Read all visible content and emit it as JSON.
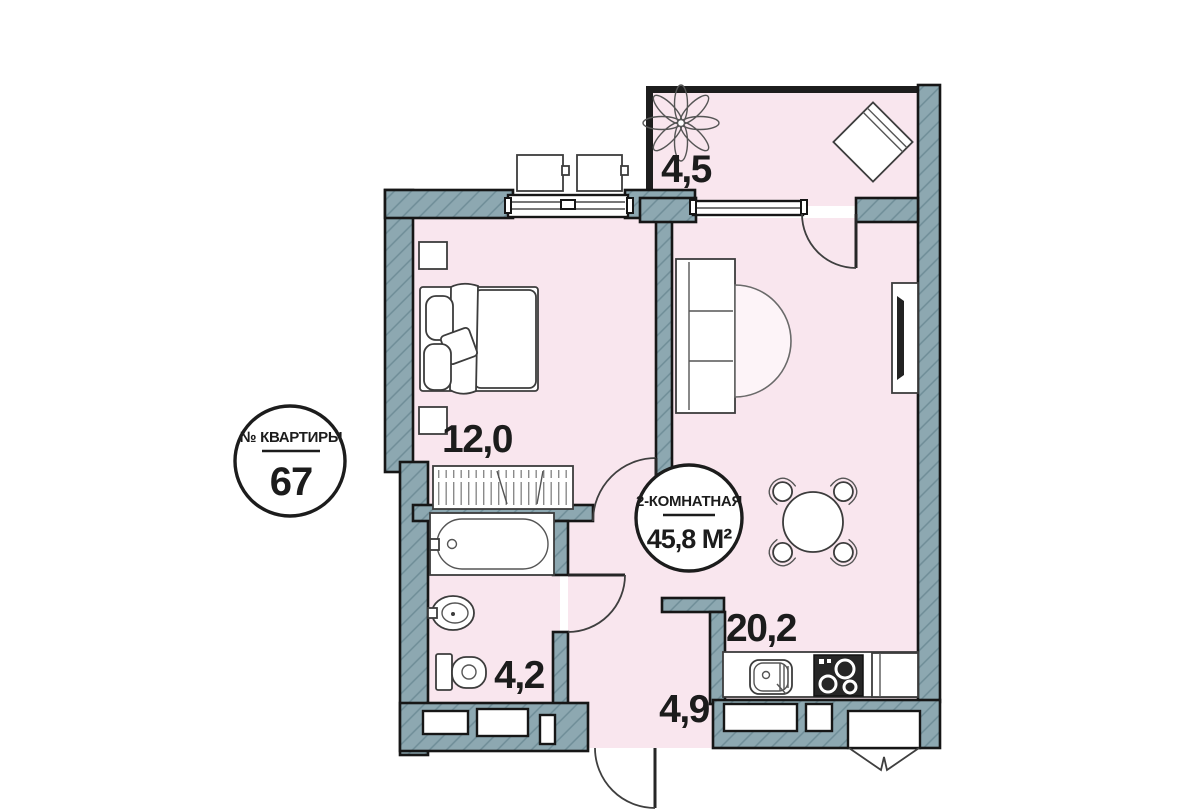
{
  "plan": {
    "apartment_badge": {
      "label": "№ КВАРТИРЫ",
      "number": "67"
    },
    "info_badge": {
      "type": "2-КОМНАТНАЯ",
      "area": "45,8 М²"
    },
    "rooms": [
      {
        "id": "balcony",
        "area_label": "4,5"
      },
      {
        "id": "bedroom",
        "area_label": "12,0"
      },
      {
        "id": "bathroom",
        "area_label": "4,2"
      },
      {
        "id": "hallway",
        "area_label": "4,9"
      },
      {
        "id": "kitchen-living",
        "area_label": "20,2"
      }
    ],
    "colors": {
      "background": "#ffffff",
      "room_fill": "#f9e6ee",
      "wall_fill": "#8da8b1",
      "wall_hatch": "#6e8d97",
      "outline": "#161616"
    }
  }
}
